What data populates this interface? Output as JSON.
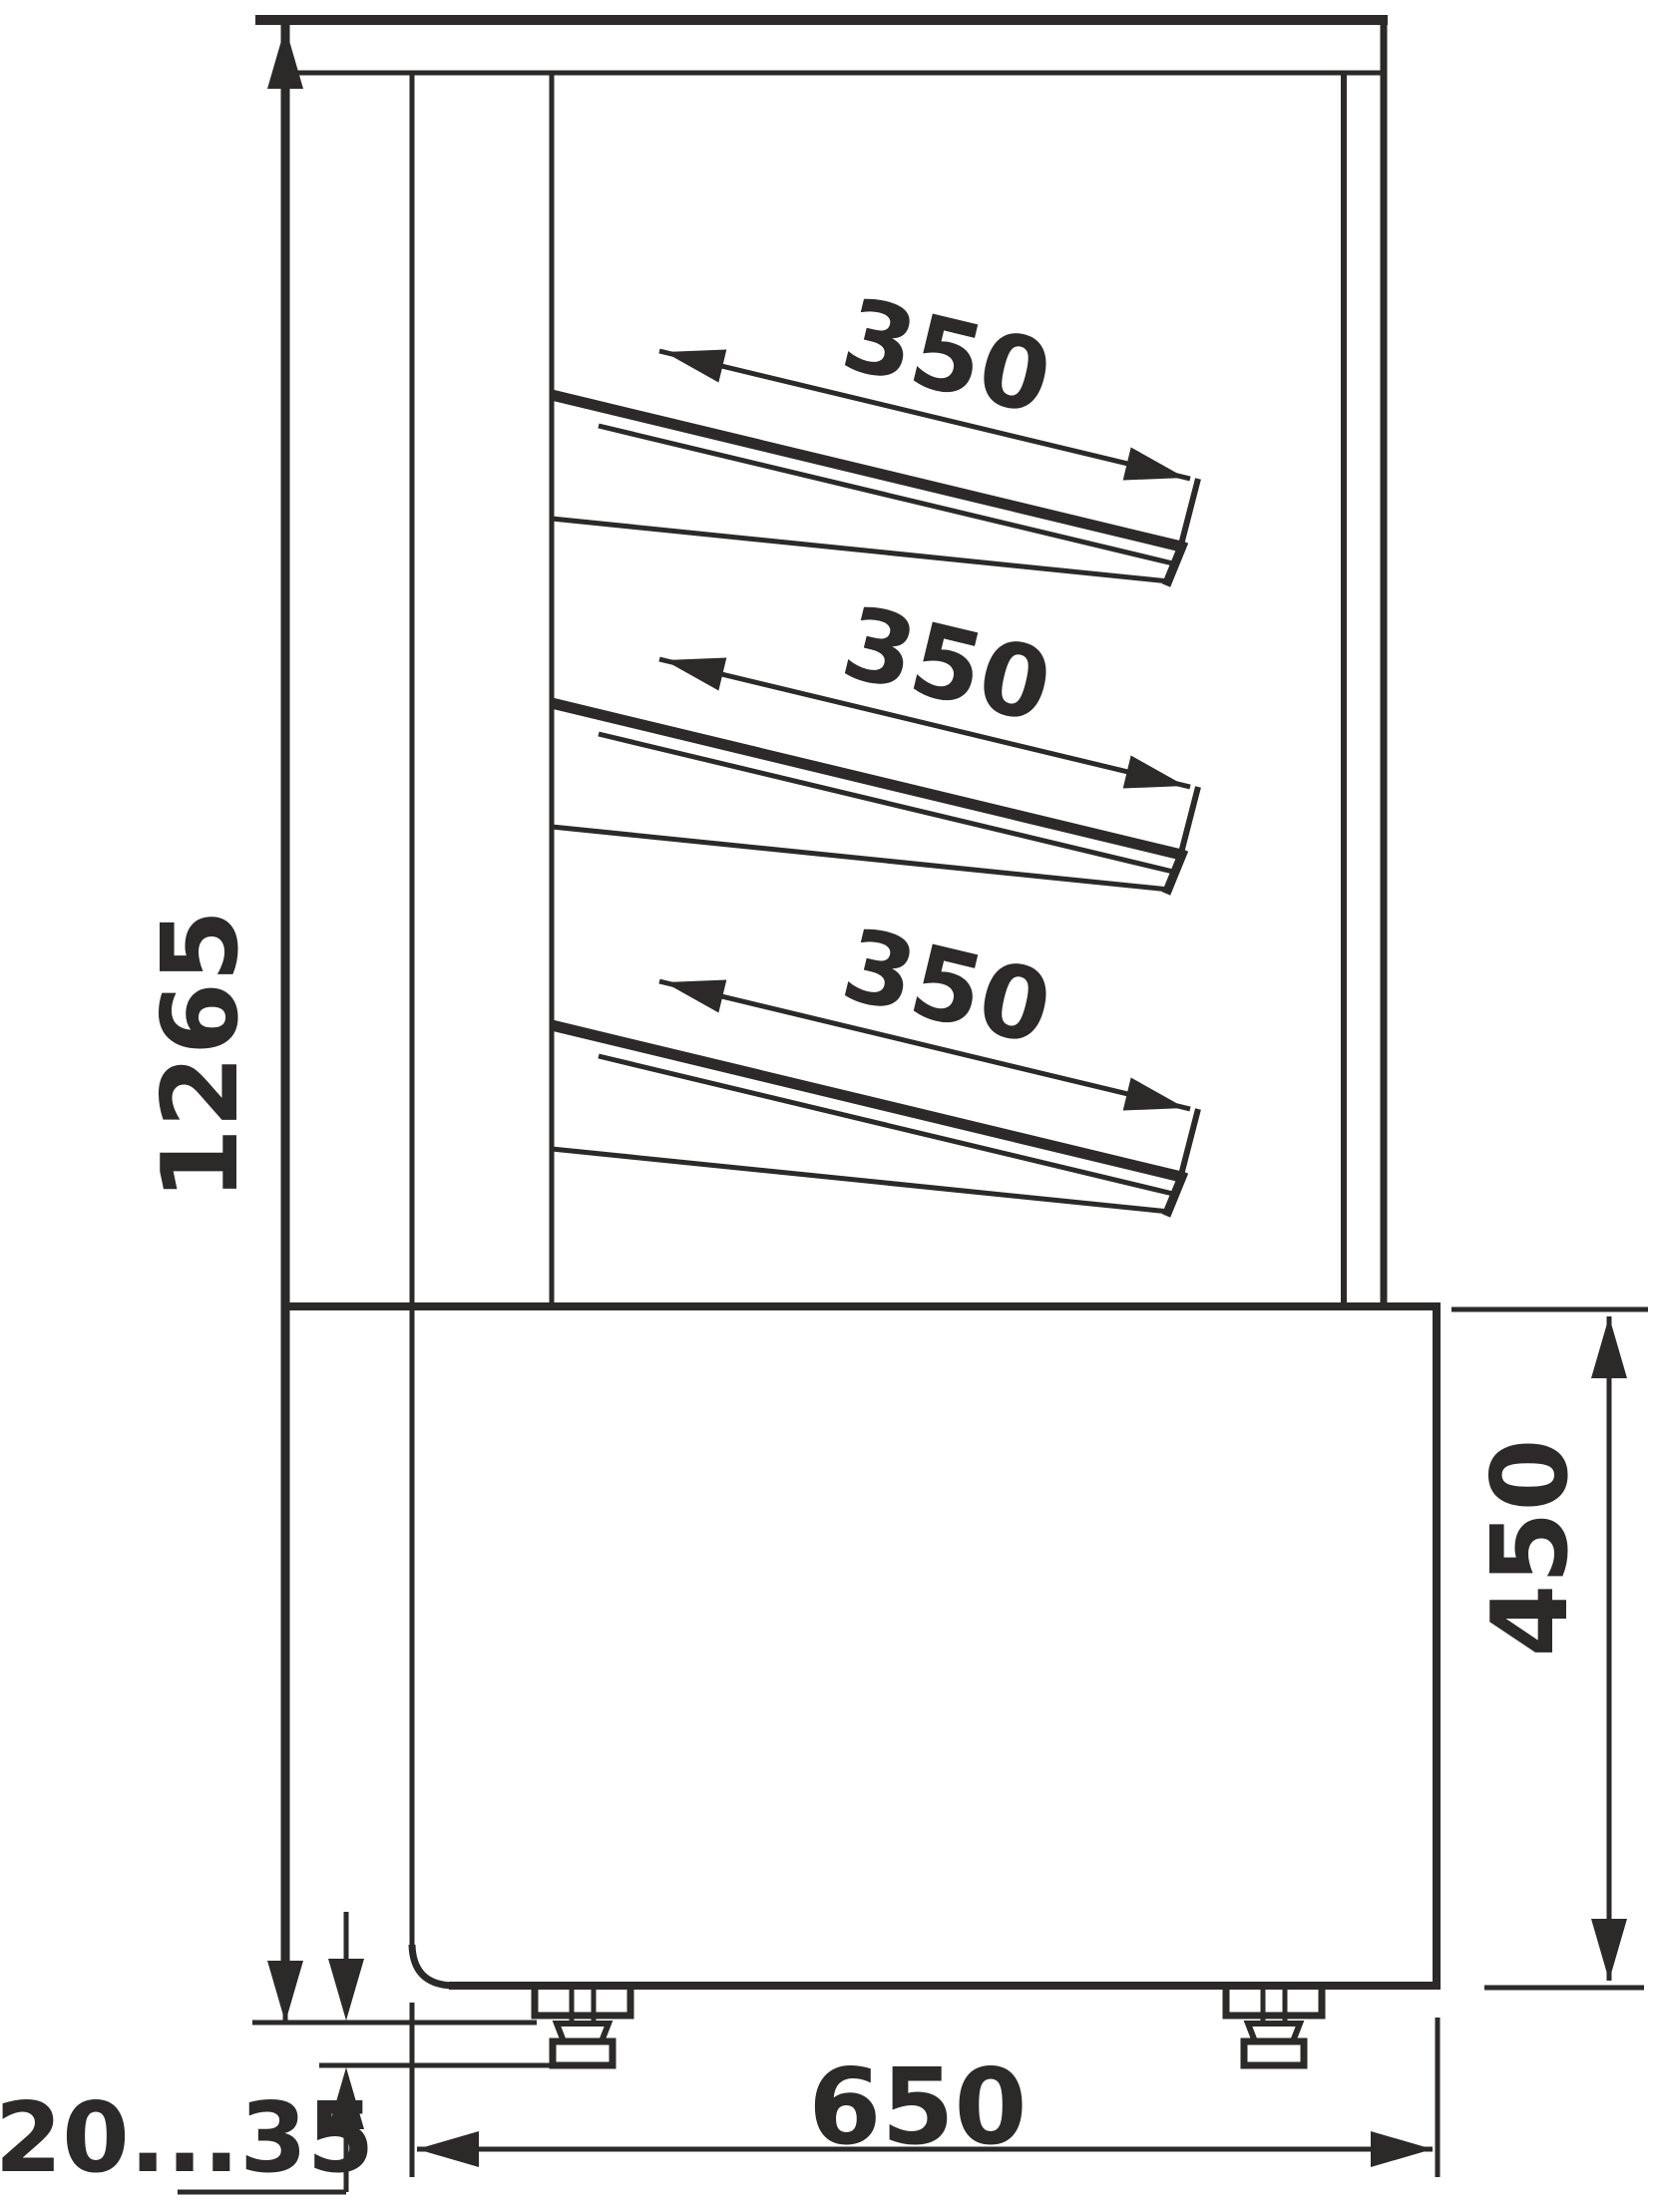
{
  "title": "Display case side-view dimensional drawing",
  "units": "mm",
  "colors": {
    "line": "#2b2a29",
    "background": "#ffffff"
  },
  "dimensions": {
    "overall_height": {
      "value": "1265",
      "orientation": "vertical-left"
    },
    "shelf_depth_top": {
      "value": "350",
      "orientation": "along-shelf"
    },
    "shelf_depth_middle": {
      "value": "350",
      "orientation": "along-shelf"
    },
    "shelf_depth_bottom": {
      "value": "350",
      "orientation": "along-shelf"
    },
    "base_height": {
      "value": "450",
      "orientation": "vertical-right"
    },
    "base_depth": {
      "value": "650",
      "orientation": "horizontal-bottom"
    },
    "foot_adjust_range": {
      "value": "20...35",
      "orientation": "horizontal-bottom-left"
    }
  }
}
